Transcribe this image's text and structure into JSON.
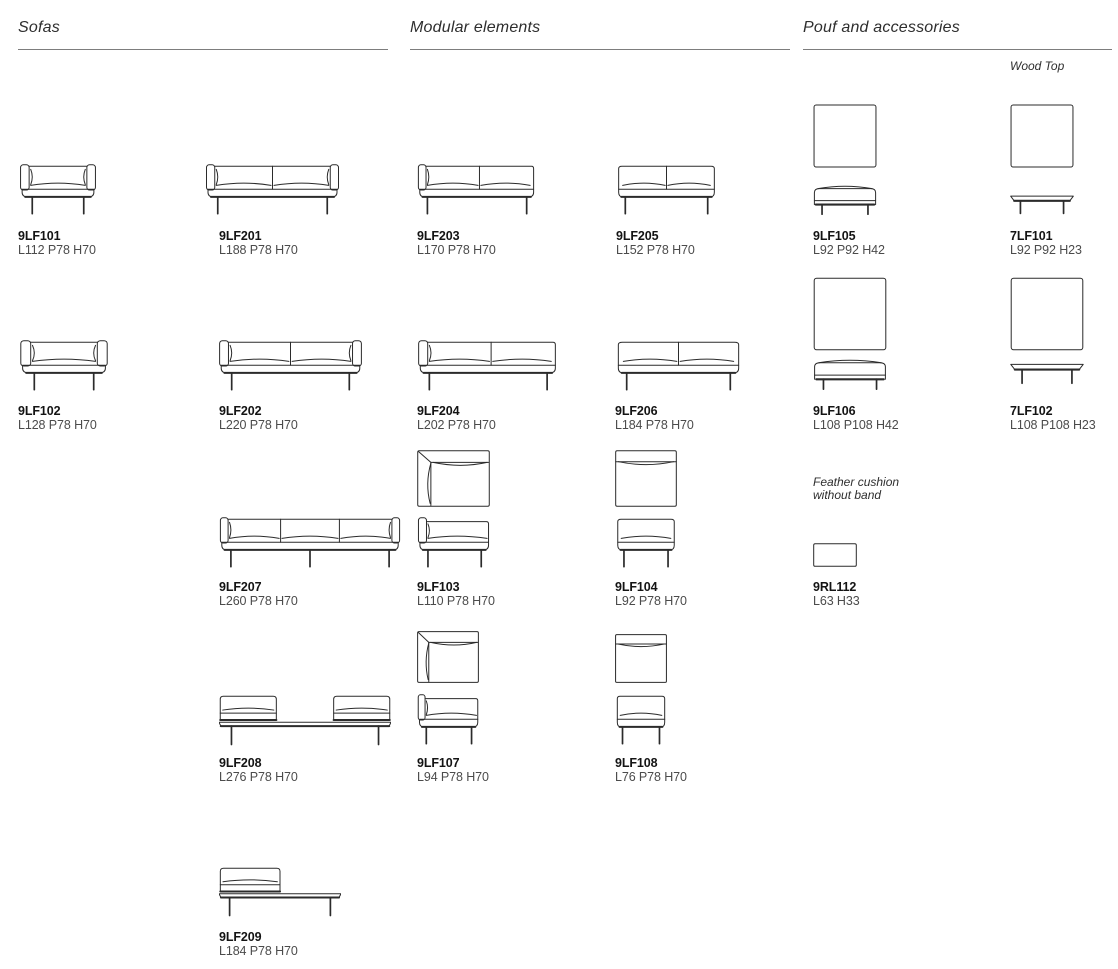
{
  "sections": {
    "sofas": {
      "title": "Sofas"
    },
    "modular": {
      "title": "Modular elements"
    },
    "pouf": {
      "title": "Pouf and accessories",
      "wood_top_label": "Wood Top"
    }
  },
  "notes": {
    "feather_line1": "Feather cushion",
    "feather_line2": "without band"
  },
  "products": {
    "p9LF101": {
      "code": "9LF101",
      "dims": "L112 P78 H70"
    },
    "p9LF201": {
      "code": "9LF201",
      "dims": "L188 P78 H70"
    },
    "p9LF203": {
      "code": "9LF203",
      "dims": "L170 P78 H70"
    },
    "p9LF205": {
      "code": "9LF205",
      "dims": "L152 P78 H70"
    },
    "p9LF105": {
      "code": "9LF105",
      "dims": "L92 P92 H42"
    },
    "p7LF101": {
      "code": "7LF101",
      "dims": "L92 P92 H23"
    },
    "p9LF102": {
      "code": "9LF102",
      "dims": "L128 P78 H70"
    },
    "p9LF202": {
      "code": "9LF202",
      "dims": "L220 P78 H70"
    },
    "p9LF204": {
      "code": "9LF204",
      "dims": "L202 P78 H70"
    },
    "p9LF206": {
      "code": "9LF206",
      "dims": "L184 P78 H70"
    },
    "p9LF106": {
      "code": "9LF106",
      "dims": "L108 P108 H42"
    },
    "p7LF102": {
      "code": "7LF102",
      "dims": "L108 P108 H23"
    },
    "p9LF207": {
      "code": "9LF207",
      "dims": "L260 P78 H70"
    },
    "p9LF103": {
      "code": "9LF103",
      "dims": "L110 P78 H70"
    },
    "p9LF104": {
      "code": "9LF104",
      "dims": "L92 P78 H70"
    },
    "p9RL112": {
      "code": "9RL112",
      "dims": "L63 H33"
    },
    "p9LF208": {
      "code": "9LF208",
      "dims": "L276 P78 H70"
    },
    "p9LF107": {
      "code": "9LF107",
      "dims": "L94 P78 H70"
    },
    "p9LF108": {
      "code": "9LF108",
      "dims": "L76 P78 H70"
    },
    "p9LF209": {
      "code": "9LF209",
      "dims": "L184 P78 H70"
    }
  },
  "colors": {
    "background": "#ffffff",
    "code_text": "#141414",
    "dims_text": "#4b4b4b",
    "section_title": "#2e2e2e",
    "rule": "#7d7d7d",
    "drawing_line": "#2b2b2b"
  }
}
